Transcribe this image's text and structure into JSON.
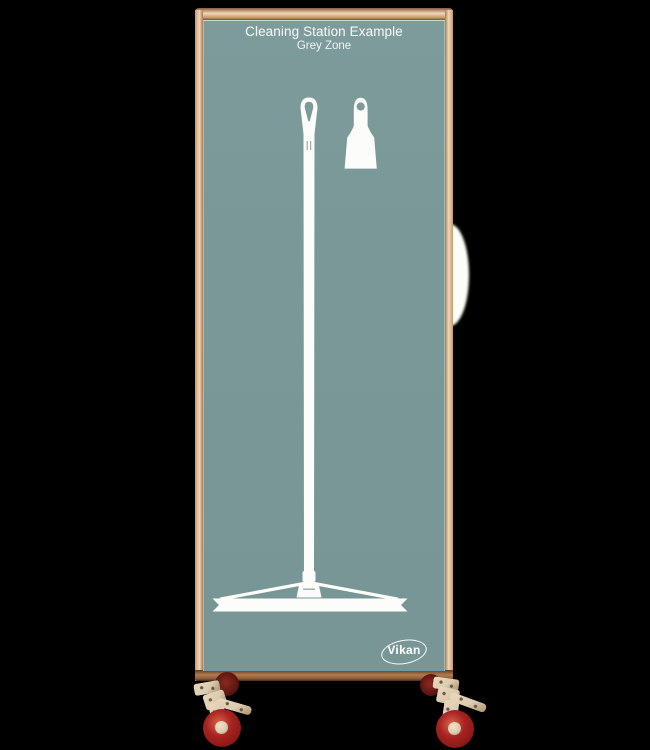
{
  "board": {
    "title": "Cleaning Station Example",
    "subtitle": "Grey Zone",
    "tool_silhouettes": [
      "floor-squeegee-with-long-handle",
      "hand-scraper"
    ]
  },
  "logo": {
    "text": "Vikan"
  },
  "colors": {
    "background": "#000000",
    "panel": "#7a9897",
    "silhouette": "#fcfdfb",
    "title_text": "#f0f5f2",
    "frame_light": "#f0d8ba",
    "frame_mid": "#c89a6e",
    "frame_dark": "#7e4e2e",
    "caster_bracket": "#dccbb0",
    "wheel_red": "#a82222",
    "rear_wheel_dark": "#5c1512"
  }
}
